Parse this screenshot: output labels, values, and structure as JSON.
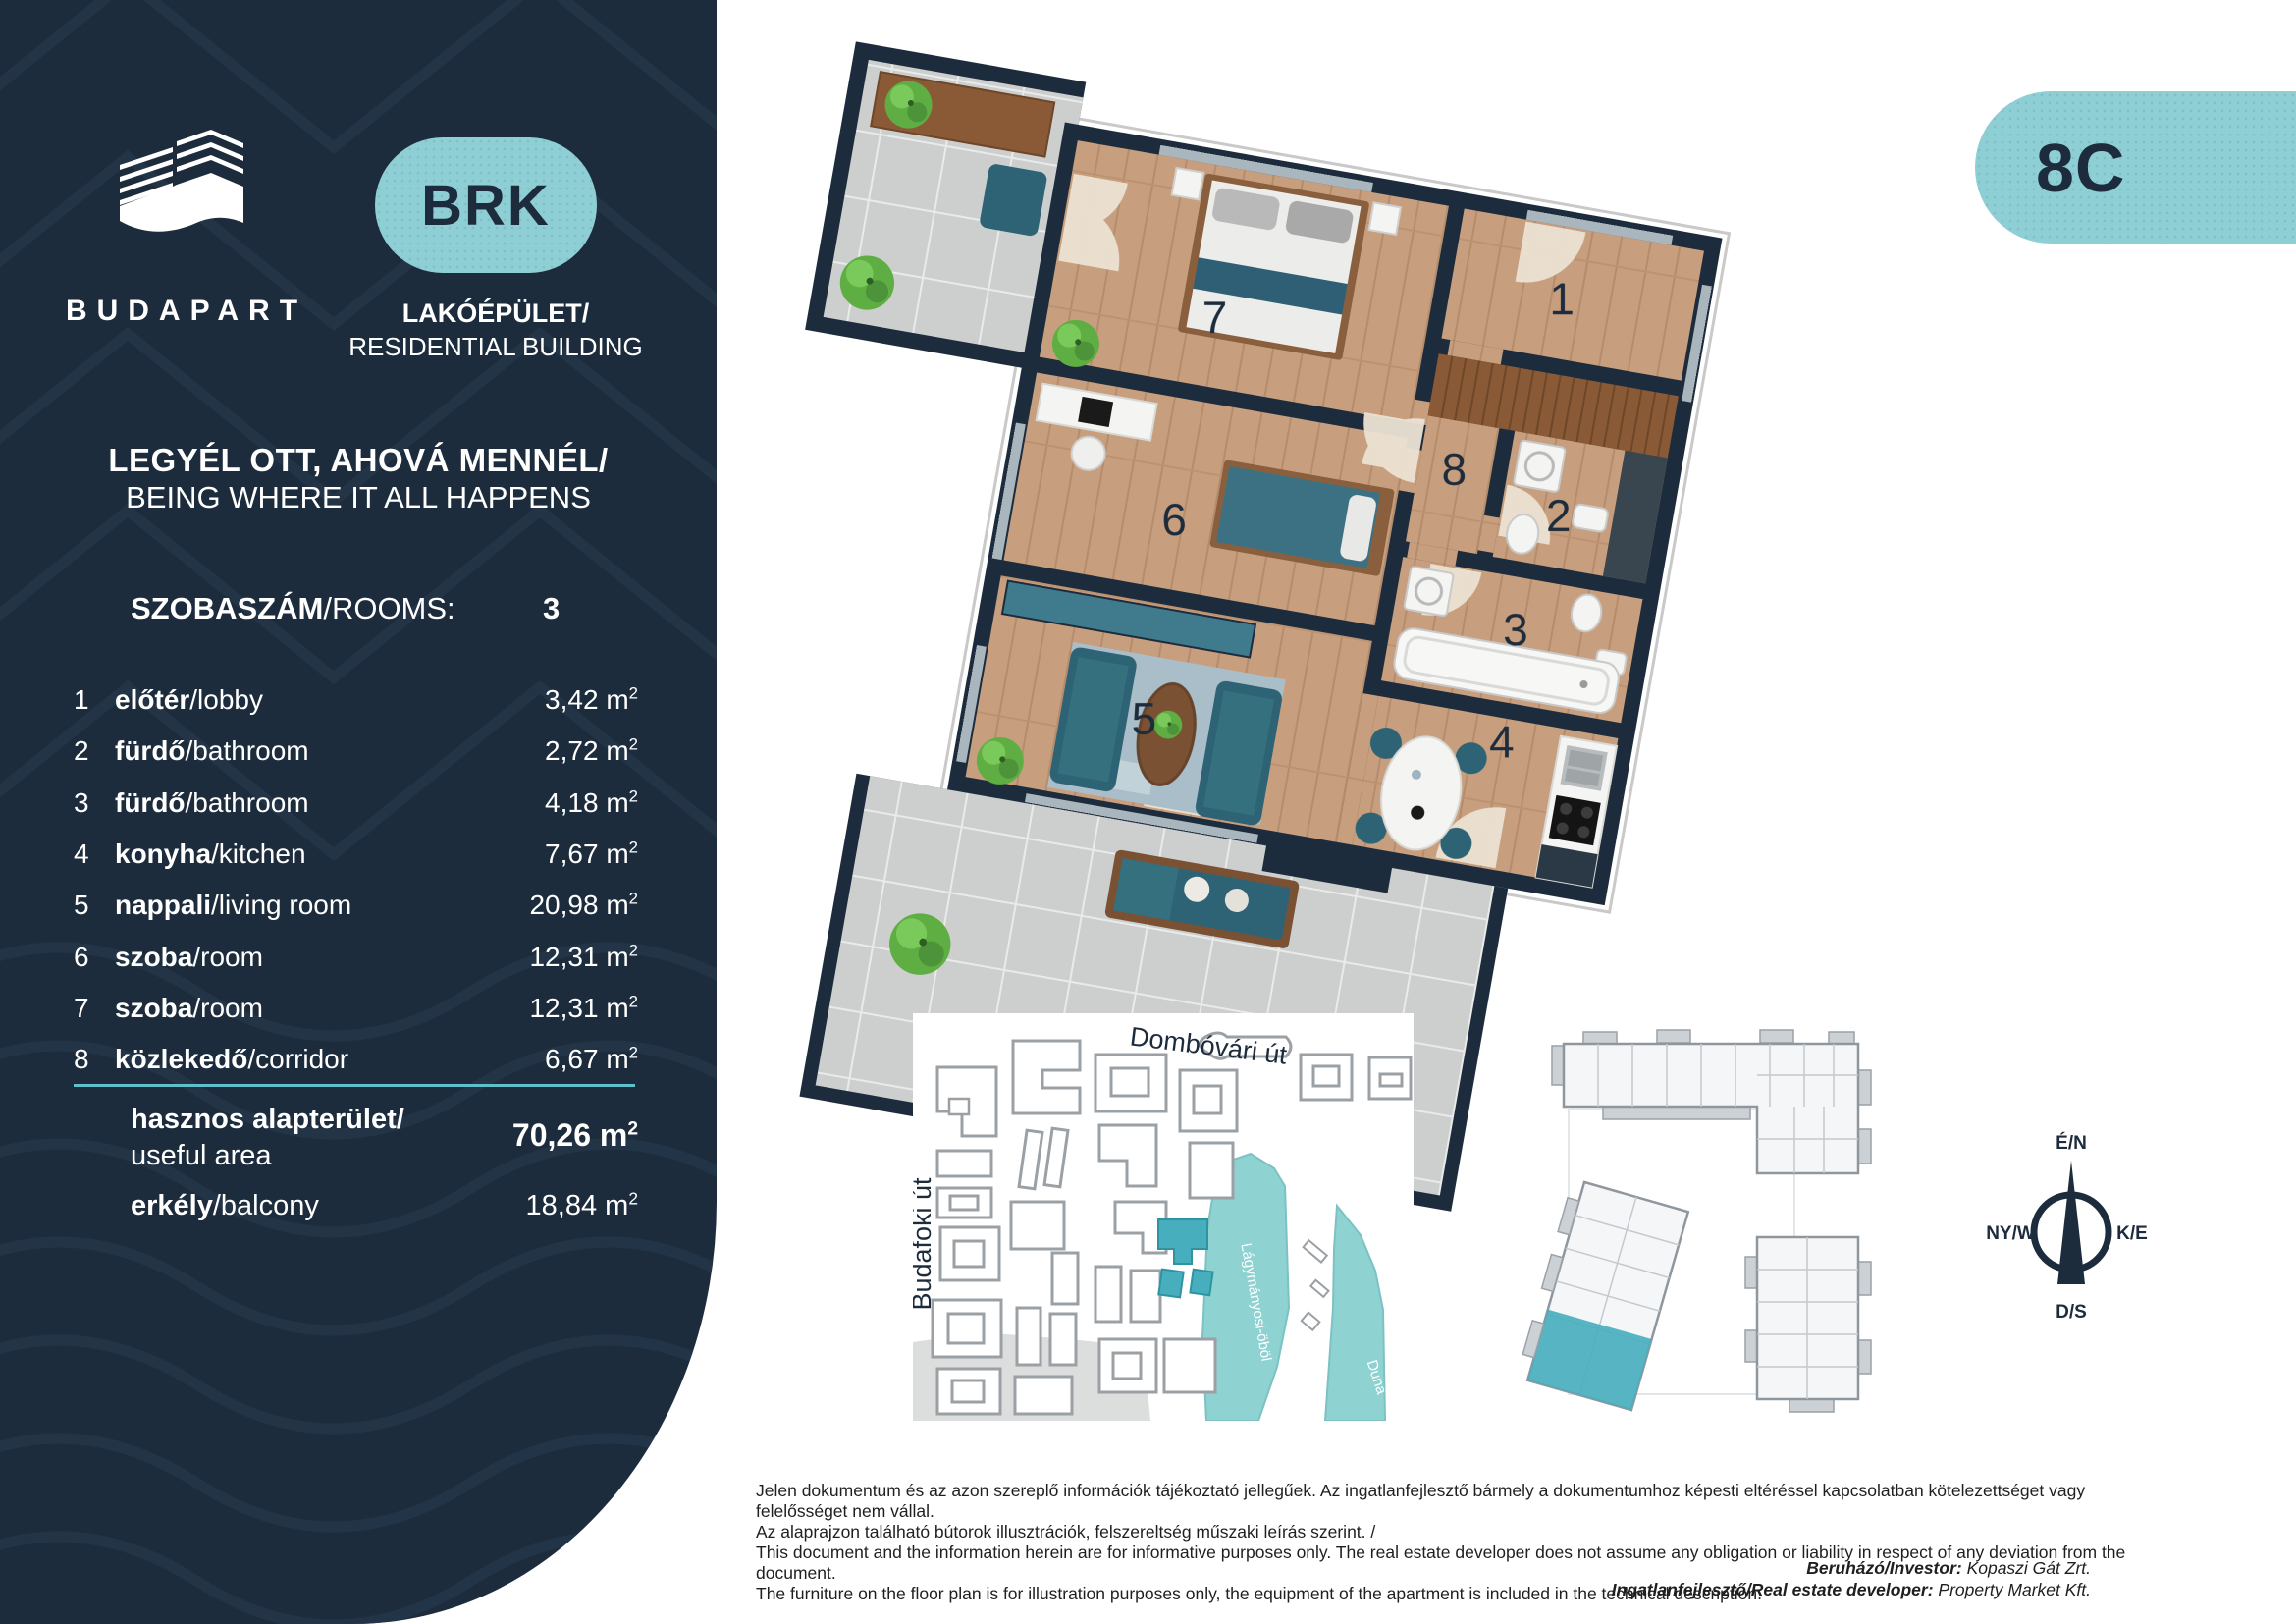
{
  "sidebar": {
    "brand": "BUDAPART",
    "badge_label": "BRK",
    "building_type": {
      "hu": "LAKÓÉPÜLET/",
      "en": "RESIDENTIAL BUILDING"
    },
    "tagline": {
      "hu": "LEGYÉL OTT, AHOVÁ MENNÉL/",
      "en": "BEING WHERE IT ALL HAPPENS"
    },
    "rooms_header": {
      "hu": "SZOBASZÁM",
      "en": "/ROOMS:",
      "value": "3"
    },
    "unit": "m",
    "unit_sup": "2",
    "rooms": [
      {
        "num": "1",
        "hu": "előtér",
        "en": "/lobby",
        "area": "3,42"
      },
      {
        "num": "2",
        "hu": "fürdő",
        "en": "/bathroom",
        "area": "2,72"
      },
      {
        "num": "3",
        "hu": "fürdő",
        "en": "/bathroom",
        "area": "4,18"
      },
      {
        "num": "4",
        "hu": "konyha",
        "en": "/kitchen",
        "area": "7,67"
      },
      {
        "num": "5",
        "hu": "nappali",
        "en": "/living room",
        "area": "20,98"
      },
      {
        "num": "6",
        "hu": "szoba",
        "en": "/room",
        "area": "12,31"
      },
      {
        "num": "7",
        "hu": "szoba",
        "en": "/room",
        "area": "12,31"
      },
      {
        "num": "8",
        "hu": "közlekedő",
        "en": "/corridor",
        "area": "6,67"
      }
    ],
    "totals": {
      "useful": {
        "hu": "hasznos alapterület/",
        "en": "useful area",
        "area": "70,26"
      },
      "balcony": {
        "hu": "erkély",
        "en": "/balcony",
        "area": "18,84"
      }
    }
  },
  "plan": {
    "unit_label": "8C",
    "room_numbers": [
      "1",
      "7",
      "8",
      "2",
      "6",
      "3",
      "5",
      "4"
    ]
  },
  "map": {
    "street_top": "Dombóvári út",
    "street_left": "Budafoki út",
    "bay_label": "Lágymányosi-öböl",
    "river_label": "Duna"
  },
  "compass": {
    "n": "É/N",
    "w": "NY/W",
    "e": "K/E",
    "s": "D/S"
  },
  "footer": {
    "disclaimer_hu1": "Jelen dokumentum és az azon szereplő információk tájékoztató jellegűek. Az ingatlanfejlesztő bármely a dokumentumhoz képesti eltéréssel kapcsolatban kötelezettséget vagy felelősséget nem vállal.",
    "disclaimer_hu2": "Az alaprajzon található bútorok illusztrációk, felszereltség műszaki leírás szerint. /",
    "disclaimer_en1": "This document and the information herein are for informative purposes only. The real estate developer does not assume any obligation or liability in respect of any deviation from the document.",
    "disclaimer_en2": "The furniture on the floor plan is for illustration purposes only, the equipment of the apartment is included in the technical description.",
    "investor_label": "Beruházó/Investor:",
    "investor_value": " Kopaszi Gát Zrt.",
    "developer_label": "Ingatlanfejlesztő/Real estate developer:",
    "developer_value": " Property Market Kft."
  },
  "colors": {
    "navy": "#1d2c3c",
    "teal": "#8ecfd5",
    "teal_dark": "#46aebc",
    "water": "#8fd2d2",
    "divider": "#5fc0cb"
  }
}
